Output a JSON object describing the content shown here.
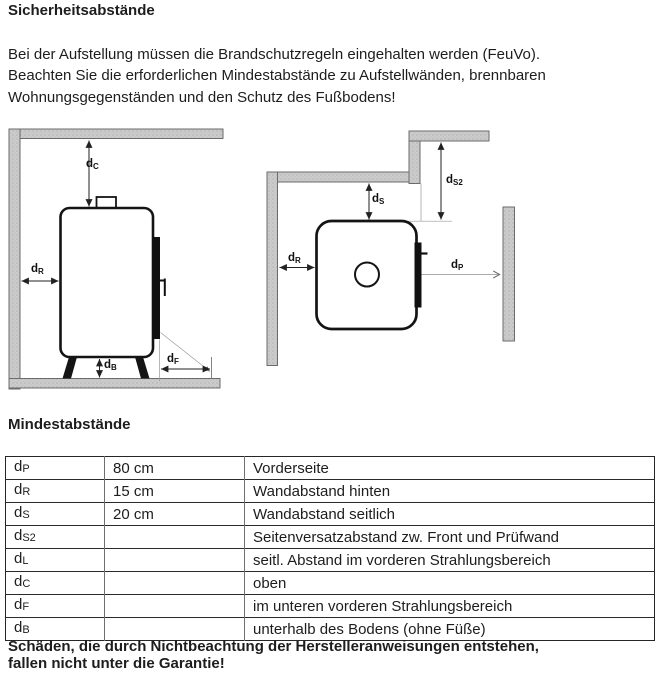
{
  "page": {
    "title": "Sicherheitsabstände",
    "intro_lines": [
      "Bei der Aufstellung müssen die Brandschutzregeln eingehalten werden (FeuVo).",
      "Beachten Sie die erforderlichen Mindestabstände zu Aufstellwänden, brennbaren",
      "Wohnungsgegenständen und den Schutz des Fußbodens!"
    ],
    "section2_title": "Mindestabstände",
    "warning_lines": [
      "Schäden, die durch Nichtbeachtung der Herstelleranweisungen entstehen,",
      "fallen nicht unter die Garantie!"
    ]
  },
  "diagram": {
    "left_view": {
      "labels": {
        "dC": {
          "base": "d",
          "sub": "C"
        },
        "dR": {
          "base": "d",
          "sub": "R"
        },
        "dB": {
          "base": "d",
          "sub": "B"
        },
        "dF": {
          "base": "d",
          "sub": "F"
        }
      }
    },
    "right_view": {
      "labels": {
        "dS": {
          "base": "d",
          "sub": "S"
        },
        "dS2": {
          "base": "d",
          "sub": "S2"
        },
        "dR": {
          "base": "d",
          "sub": "R"
        },
        "dP": {
          "base": "d",
          "sub": "P"
        }
      }
    }
  },
  "table": {
    "rows": [
      {
        "base": "d",
        "sub": "P",
        "value": "80 cm",
        "desc": "Vorderseite"
      },
      {
        "base": "d",
        "sub": "R",
        "value": "15 cm",
        "desc": "Wandabstand hinten"
      },
      {
        "base": "d",
        "sub": "S",
        "value": "20 cm",
        "desc": "Wandabstand seitlich"
      },
      {
        "base": "d",
        "sub": "S2",
        "value": "",
        "desc": "Seitenversatzabstand zw. Front und Prüfwand"
      },
      {
        "base": "d",
        "sub": "L",
        "value": "",
        "desc": "seitl. Abstand im vorderen Strahlungsbereich"
      },
      {
        "base": "d",
        "sub": "C",
        "value": "",
        "desc": "oben"
      },
      {
        "base": "d",
        "sub": "F",
        "value": "",
        "desc": "im unteren vorderen Strahlungsbereich"
      },
      {
        "base": "d",
        "sub": "B",
        "value": "",
        "desc": "unterhalb des Bodens (ohne Füße)"
      }
    ]
  },
  "colors": {
    "wall_fill": "#cbcbcb",
    "wall_dot": "#a6a6a6",
    "wall_stroke": "#6b6b6b",
    "stove_stroke": "#141414",
    "arrow": "#222222",
    "guide": "#8f8f8f",
    "text": "#1d1d1d"
  }
}
